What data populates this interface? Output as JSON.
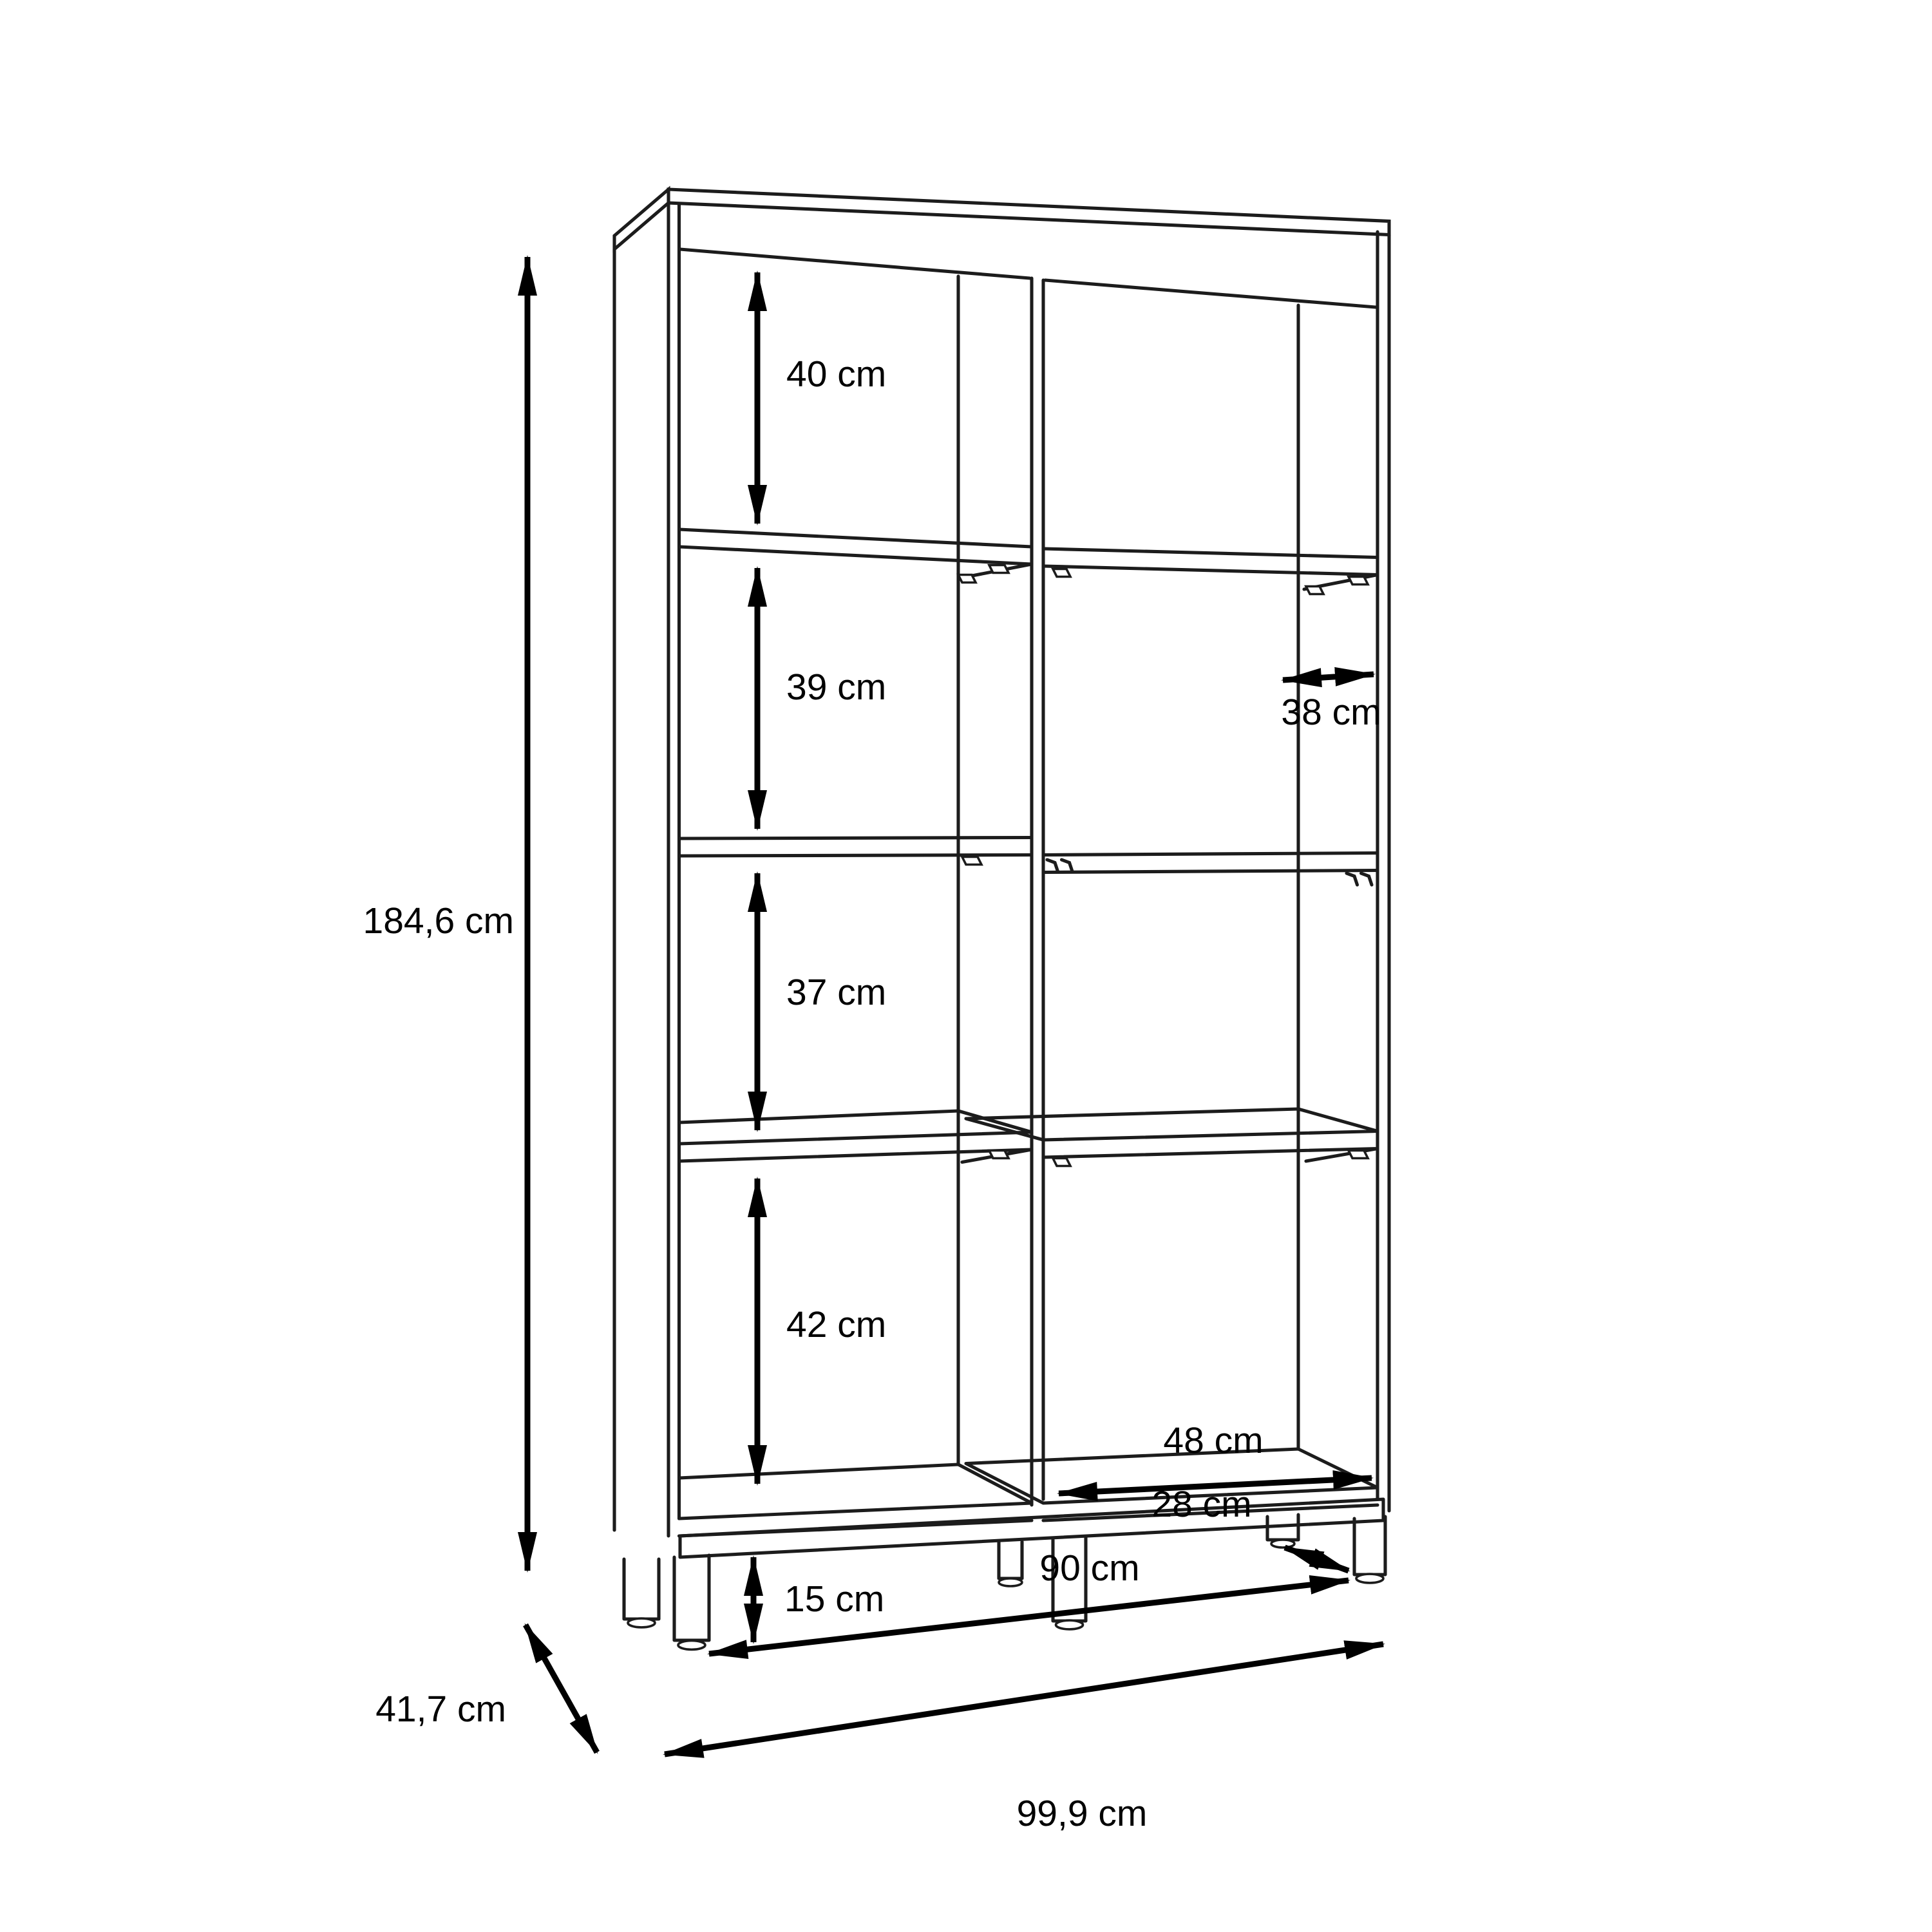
{
  "page": {
    "background": "#ffffff",
    "line_color": "#1c1c1c",
    "accent_color": "#000000"
  },
  "diagram": {
    "type": "furniture-dimension-drawing",
    "subject": "Open shelf cabinet with two columns, four shelf rows and a base frame with six legs",
    "units": "cm",
    "dimensions": {
      "overall_height": {
        "label": "184,6 cm",
        "value": 184.6,
        "unit": "cm",
        "measures": "total height of cabinet"
      },
      "row1_height": {
        "label": "40 cm",
        "value": 40,
        "unit": "cm",
        "measures": "top compartment inner height"
      },
      "row2_height": {
        "label": "39 cm",
        "value": 39,
        "unit": "cm",
        "measures": "second compartment inner height"
      },
      "row3_height": {
        "label": "37 cm",
        "value": 37,
        "unit": "cm",
        "measures": "third compartment inner height"
      },
      "row4_height": {
        "label": "42 cm",
        "value": 42,
        "unit": "cm",
        "measures": "bottom compartment inner height"
      },
      "shelf_depth": {
        "label": "38 cm",
        "value": 38,
        "unit": "cm",
        "measures": "inner shelf depth"
      },
      "bottom_inner_width": {
        "label": "48 cm",
        "value": 48,
        "unit": "cm",
        "measures": "inner width of right column"
      },
      "base_height": {
        "label": "15 cm",
        "value": 15,
        "unit": "cm",
        "measures": "base frame / leg height"
      },
      "leg_span_width": {
        "label": "90 cm",
        "value": 90,
        "unit": "cm",
        "measures": "front leg span width"
      },
      "leg_span_depth": {
        "label": "28 cm",
        "value": 28,
        "unit": "cm",
        "measures": "front-to-back leg span depth"
      },
      "overall_depth": {
        "label": "41,7 cm",
        "value": 41.7,
        "unit": "cm",
        "measures": "total depth of cabinet"
      },
      "overall_width": {
        "label": "99,9 cm",
        "value": 99.9,
        "unit": "cm",
        "measures": "total width of cabinet"
      }
    }
  }
}
